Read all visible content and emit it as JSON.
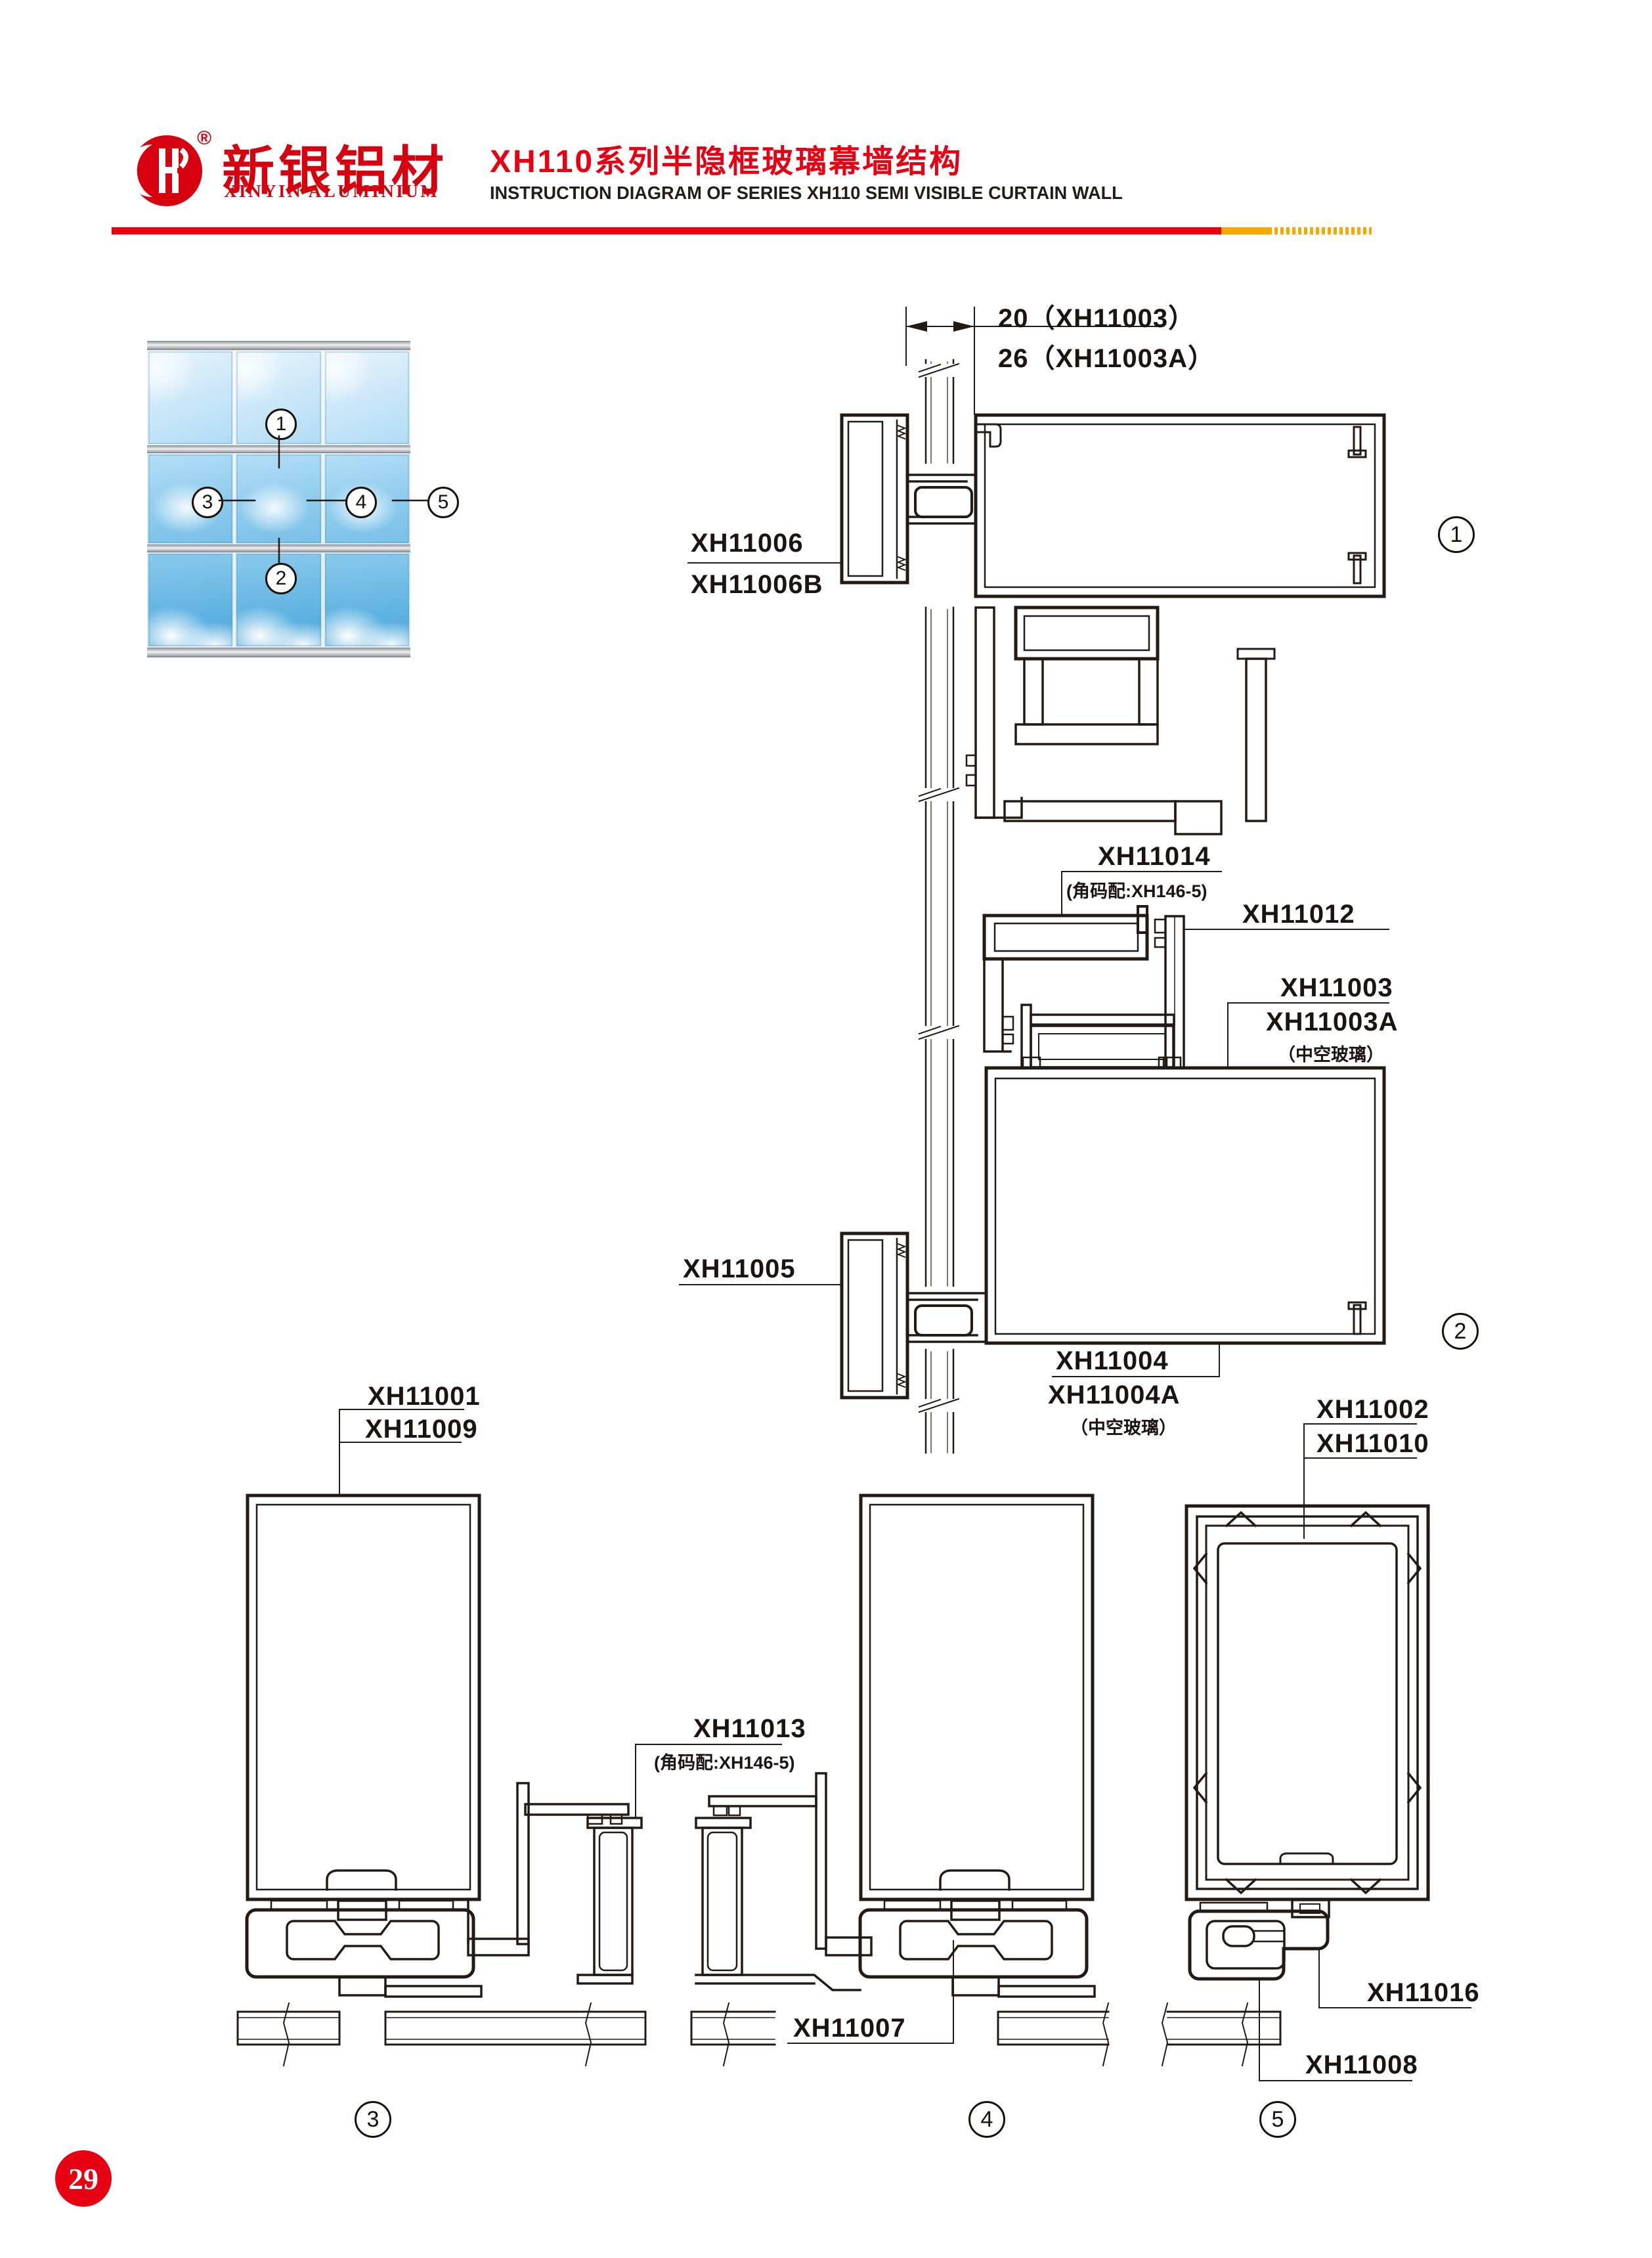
{
  "page": {
    "number": "29"
  },
  "header": {
    "logo_cn": "新银铝材",
    "logo_en": "XINYIN ALUMINIUM",
    "registered": "®",
    "title_cn": "XH110系列半隐框玻璃幕墙结构",
    "title_en": "INSTRUCTION DIAGRAM OF SERIES XH110 SEMI VISIBLE CURTAIN WALL",
    "accent_red": "#e60012",
    "accent_orange": "#f5a800"
  },
  "photo": {
    "callouts": [
      "1",
      "2",
      "3",
      "4",
      "5"
    ],
    "sky_light": "#cfe9f9",
    "sky_deep": "#47a5d9"
  },
  "details": {
    "d1": {
      "dim_a": "20（XH11003）",
      "dim_b": "26（XH11003A）",
      "part_a": "XH11006",
      "part_b": "XH11006B",
      "badge": "1"
    },
    "d2": {
      "part_top": "XH11014",
      "part_top_note": "(角码配:XH146-5)",
      "part_right": "XH11012",
      "glass_a": "XH11003",
      "glass_a2": "XH11003A",
      "glass_a_note": "（中空玻璃）",
      "part_left": "XH11005",
      "glass_b": "XH11004",
      "glass_b2": "XH11004A",
      "glass_b_note": "（中空玻璃）",
      "badge": "2"
    },
    "d3": {
      "part_a": "XH11001",
      "part_b": "XH11009",
      "part_mid": "XH11013",
      "part_mid_note": "(角码配:XH146-5)",
      "part_bottom": "XH11007",
      "badge": "3"
    },
    "d4": {
      "badge": "4"
    },
    "d5": {
      "part_a": "XH11002",
      "part_b": "XH11010",
      "part_clip": "XH11016",
      "part_bottom": "XH11008",
      "badge": "5"
    }
  }
}
